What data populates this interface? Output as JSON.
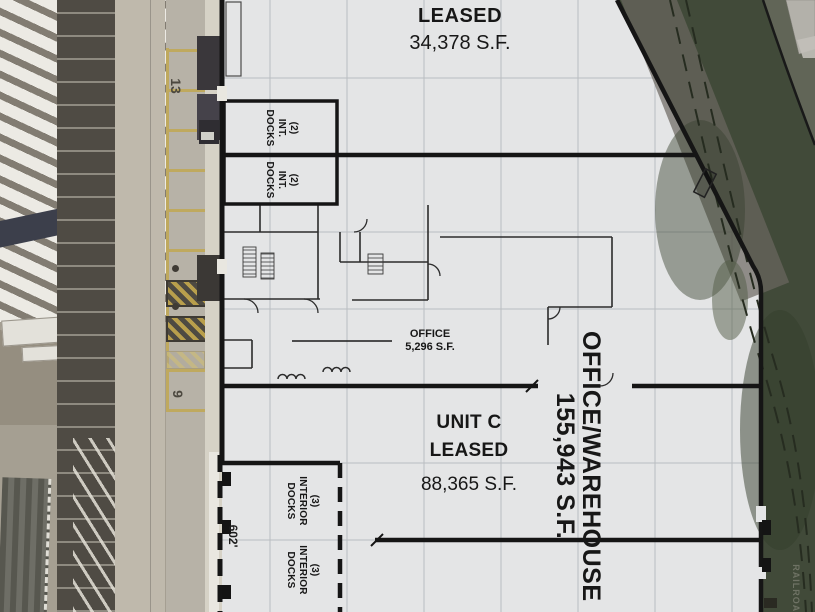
{
  "site_plan": {
    "top_unit": {
      "status": "LEASED",
      "area": "34,378 S.F."
    },
    "upper_docks": [
      {
        "lines": [
          "(2)",
          "INT.",
          "DOCKS"
        ]
      },
      {
        "lines": [
          "(2)",
          "INT.",
          "DOCKS"
        ]
      }
    ],
    "office": {
      "name": "OFFICE",
      "area": "5,296 S.F."
    },
    "unit_c": {
      "name": "UNIT C",
      "status": "LEASED",
      "area": "88,365 S.F."
    },
    "office_warehouse": {
      "name": "OFFICE/WAREHOUSE",
      "area": "155,943 S.F."
    },
    "interior_docks": [
      {
        "lines": [
          "(3)",
          "INTERIOR",
          "DOCKS"
        ]
      },
      {
        "lines": [
          "(3)",
          "INTERIOR",
          "DOCKS"
        ]
      }
    ],
    "dimension": "602'",
    "railroad_label": "RAILROAD",
    "pavement_numbers": {
      "upper": "13",
      "lower": "9"
    },
    "colors": {
      "wall": "#151515",
      "floor": "#e4e5e6",
      "grid": "#b9bdc1",
      "rail_green": "#414a39",
      "stall_yellow": "#bfa95e",
      "asphalt": "#4f4b44"
    }
  }
}
